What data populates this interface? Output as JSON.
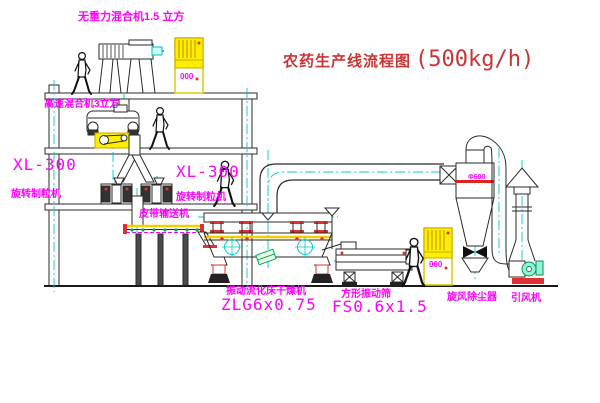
{
  "diagram": {
    "title": "农药生产线流程图",
    "capacity": "(500kg/h)"
  },
  "labels": {
    "gravity_mixer": "无重力混合机1.5 立方",
    "speed_mixer": "高速混合机3立方",
    "granulator_left": {
      "model": "XL-300",
      "name": "旋转制粒机"
    },
    "granulator_mid": {
      "model": "XL-300",
      "name": "旋转制粒机"
    },
    "belt_conveyor": "皮带输送机",
    "dryer": {
      "name": "振动流化床干燥机",
      "model": "ZLG6x0.75"
    },
    "sieve": {
      "name": "方形振动筛",
      "model": "FS0.6x1.5"
    },
    "cyclone": {
      "name": "旋风除尘器",
      "size": "Φ600"
    },
    "fan": {
      "name": "引风机"
    },
    "cabinet1_display": "000",
    "cabinet2_display": "000"
  },
  "colors": {
    "label_magenta": "#ff00ff",
    "title_red": "#cc3333",
    "line": "#2a2a2a",
    "centerline_cyan": "#00cccc",
    "equipment_yellow": "#ffee00",
    "accent_red": "#e03030",
    "accent_green": "#00a550"
  }
}
